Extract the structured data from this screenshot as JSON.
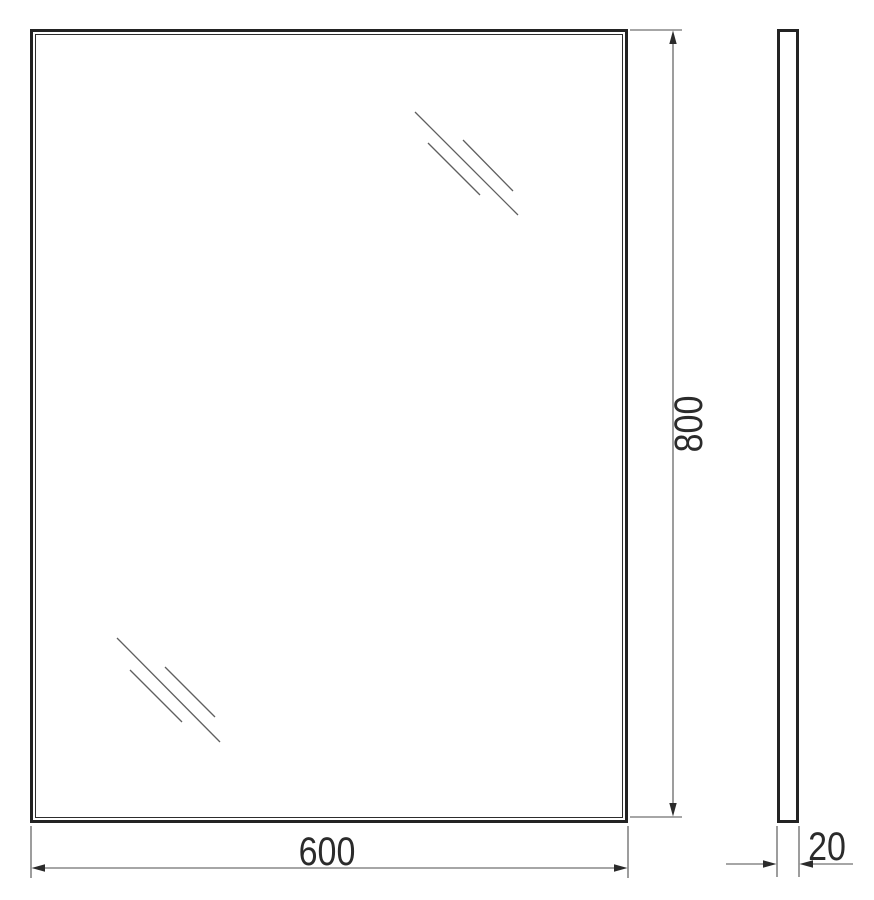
{
  "dimensions": {
    "width": "600",
    "height": "800",
    "depth": "20"
  },
  "colors": {
    "background": "#ffffff",
    "frame_line": "#232323",
    "dimension_line": "#4d4d4d",
    "shine_line": "#5f5f5f",
    "label_text": "#2b2b2b"
  }
}
